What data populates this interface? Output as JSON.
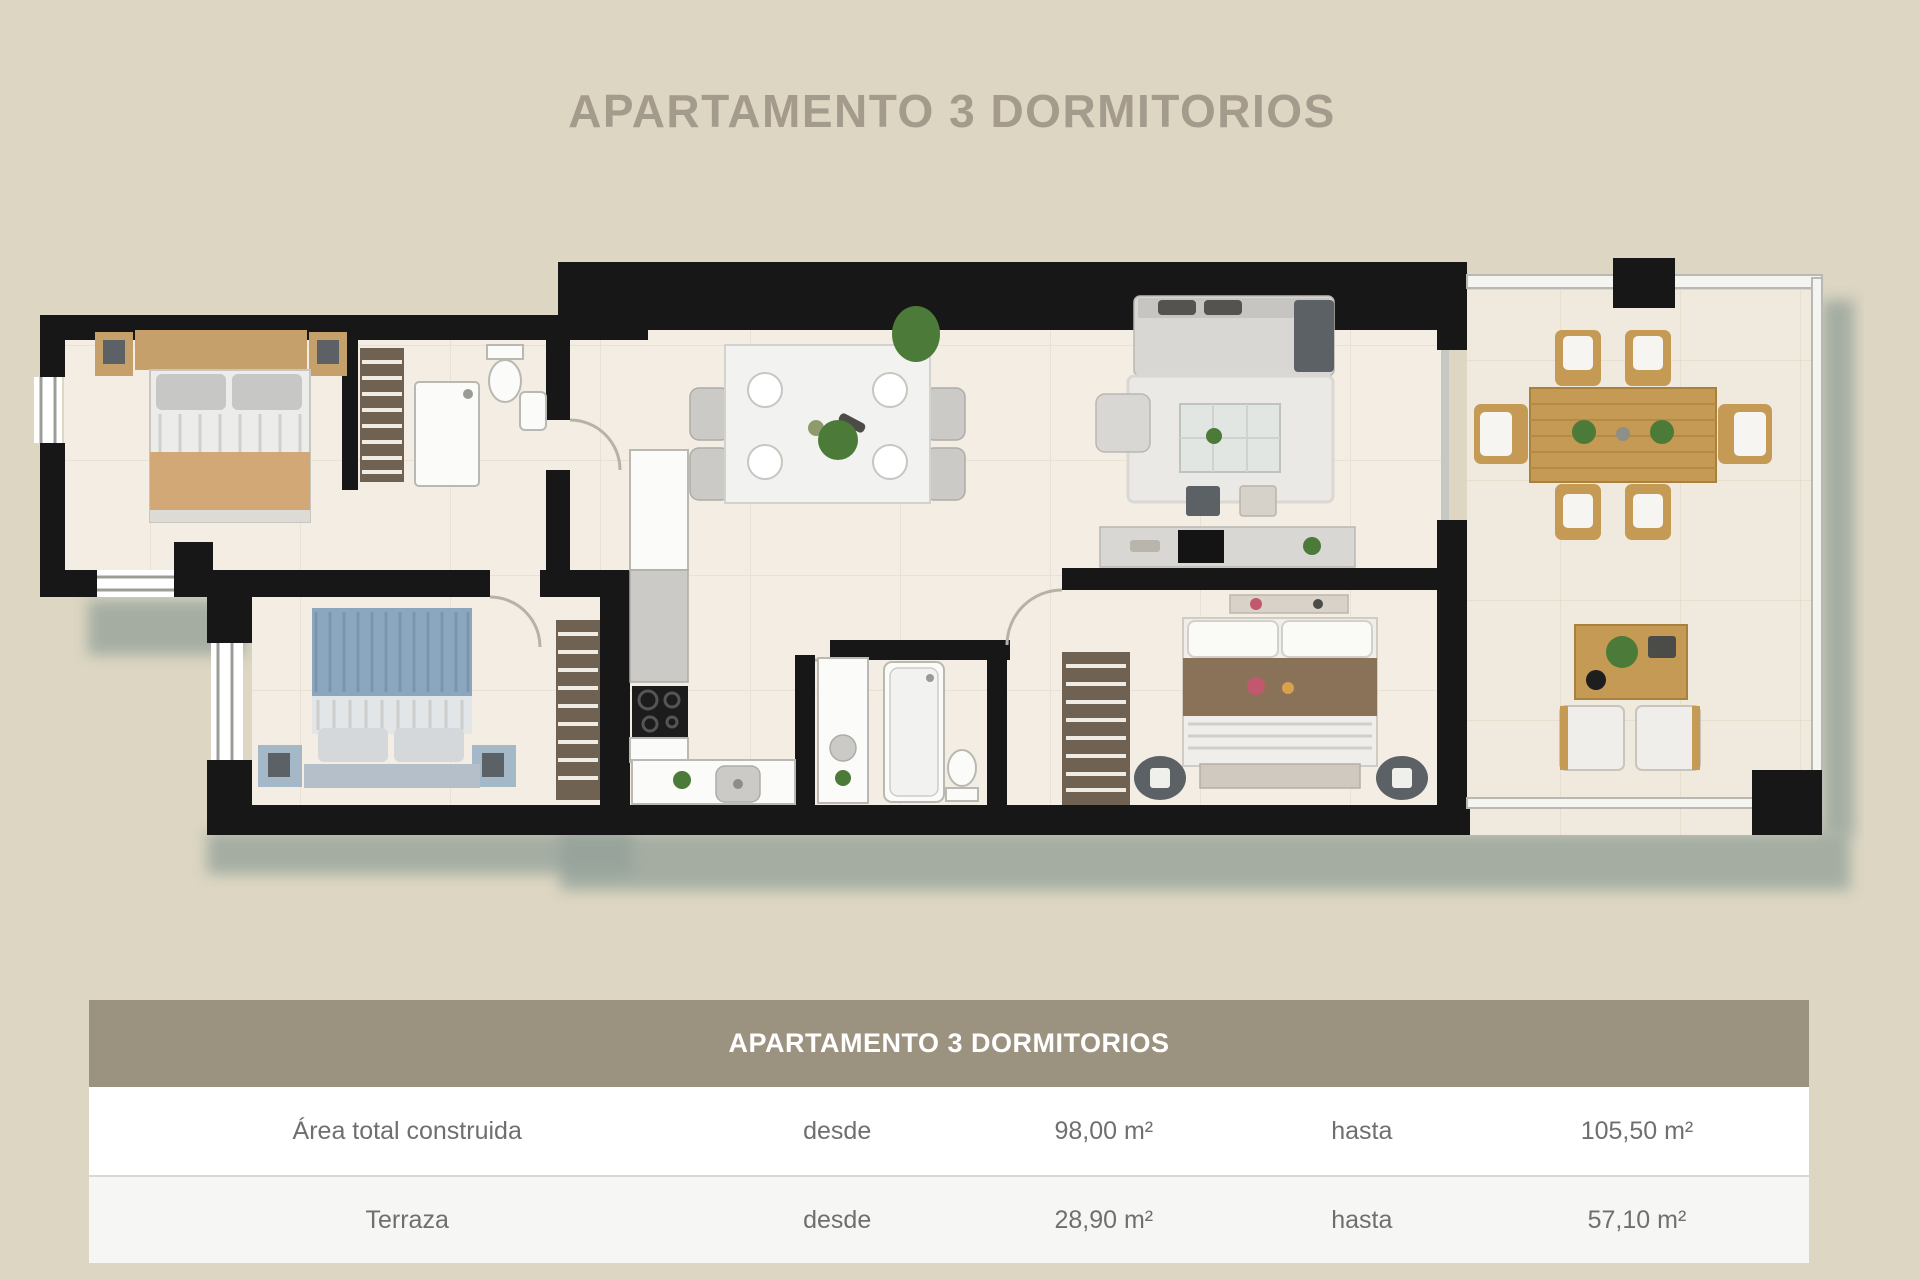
{
  "page": {
    "background": "#dcd6c2"
  },
  "title": {
    "text": "APARTAMENTO 3 DORMITORIOS",
    "color": "#a49b8c"
  },
  "table": {
    "header": {
      "title": "APARTAMENTO 3 DORMITORIOS",
      "background": "#9c9280",
      "text_color": "#ffffff"
    },
    "rows": [
      {
        "label": "Área total construida",
        "from_label": "desde",
        "from_value": "98,00 m²",
        "to_label": "hasta",
        "to_value": "105,50 m²"
      },
      {
        "label": "Terraza",
        "from_label": "desde",
        "from_value": "28,90 m²",
        "to_label": "hasta",
        "to_value": "57,10 m²"
      }
    ]
  },
  "floor_plan": {
    "palette": {
      "wall": "#171717",
      "floor": "#f3ede3",
      "floor_terrace": "#f0eade",
      "shadow": "#93a099",
      "wood": "#c6a06b",
      "wood_dark": "#c59a55",
      "closet": "#6f6252",
      "tan_blanket": "#d2a877",
      "blue_blanket": "#8ba6bf",
      "brown_blanket": "#8a7258",
      "sofa_gray": "#d9d7d3",
      "dark_accent": "#5c6166",
      "plant_green": "#4c7a38",
      "fixture_white": "#fbfbf9"
    }
  }
}
